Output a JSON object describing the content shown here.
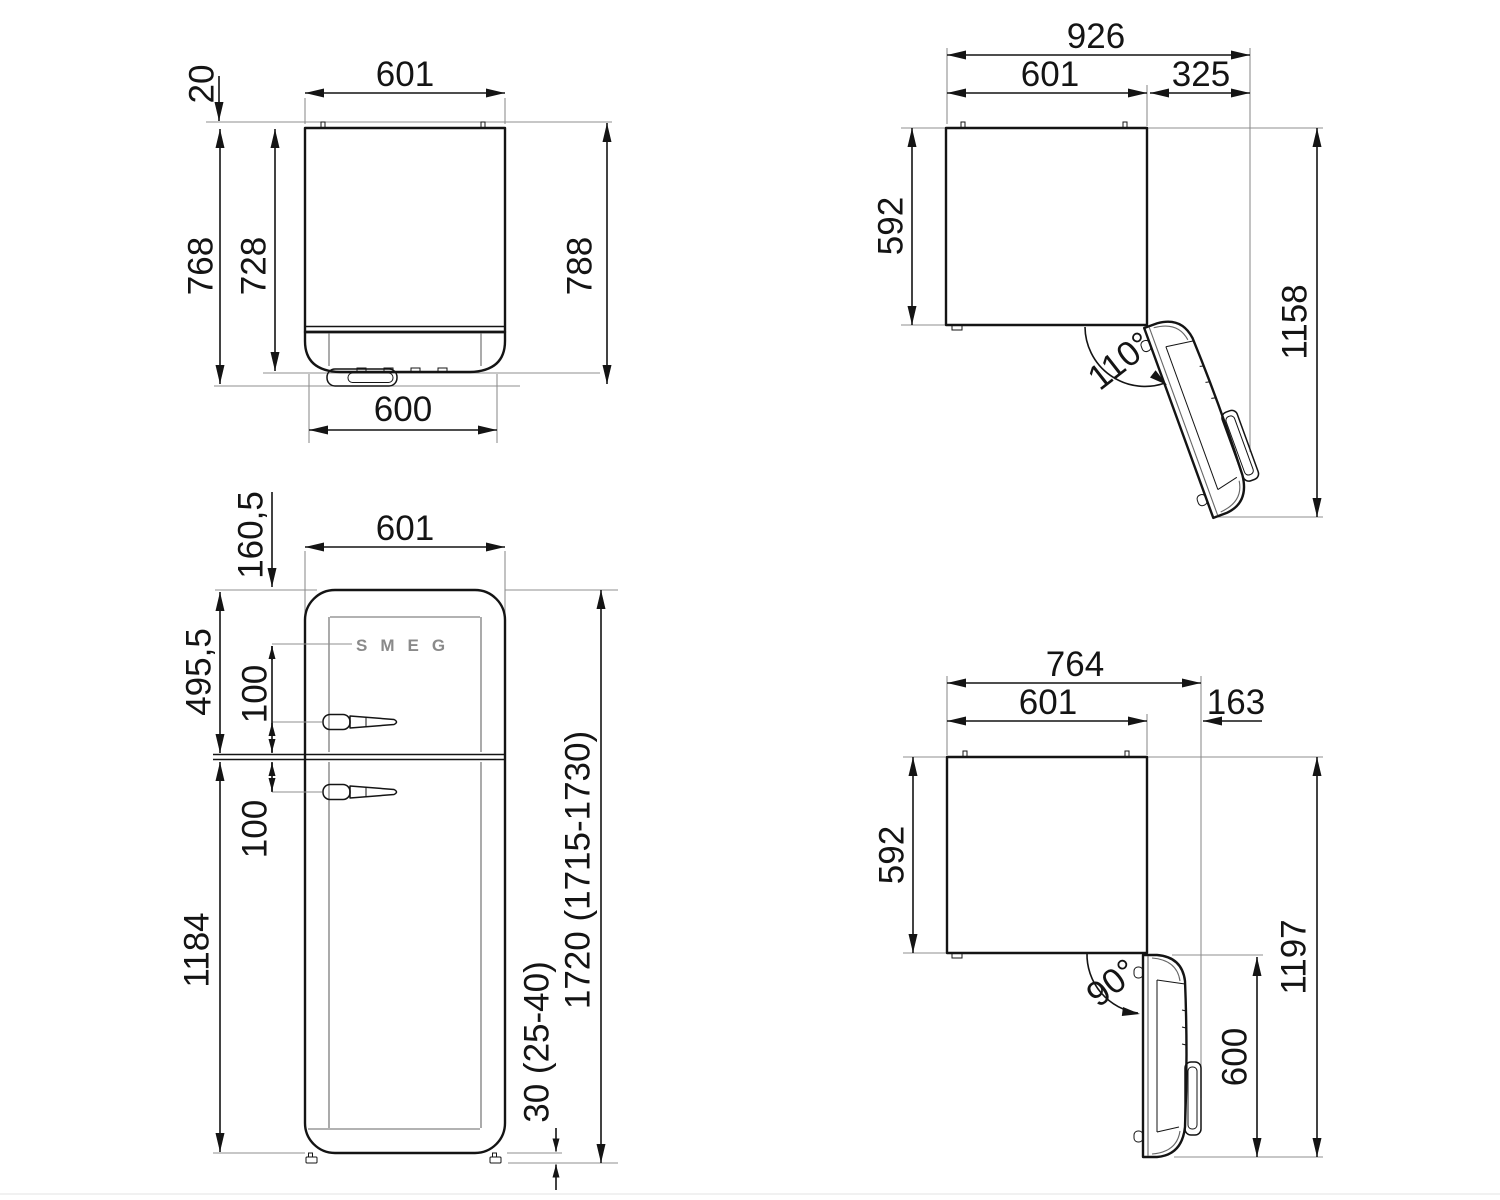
{
  "brand": "SMEG",
  "views": {
    "top_closed": {
      "width": "601",
      "hinge_offset": "20",
      "depth_with_door": "768",
      "depth_body": "728",
      "depth_overall": "788",
      "door_width": "600"
    },
    "top_open_110": {
      "overall_width": "926",
      "width": "601",
      "side_clearance": "325",
      "depth": "592",
      "overall_depth": "1158",
      "angle": "110°"
    },
    "front": {
      "width": "601",
      "logo_offset": "160,5",
      "upper_door_height": "495,5",
      "upper_handle_offset": "100",
      "lower_handle_offset": "100",
      "lower_door_height": "1184",
      "height": "1720 (1715-1730)",
      "feet_height": "30 (25-40)"
    },
    "top_open_90": {
      "overall_width": "764",
      "width": "601",
      "side_clearance": "163",
      "depth": "592",
      "overall_depth": "1197",
      "door_depth": "600",
      "angle": "90°"
    }
  }
}
